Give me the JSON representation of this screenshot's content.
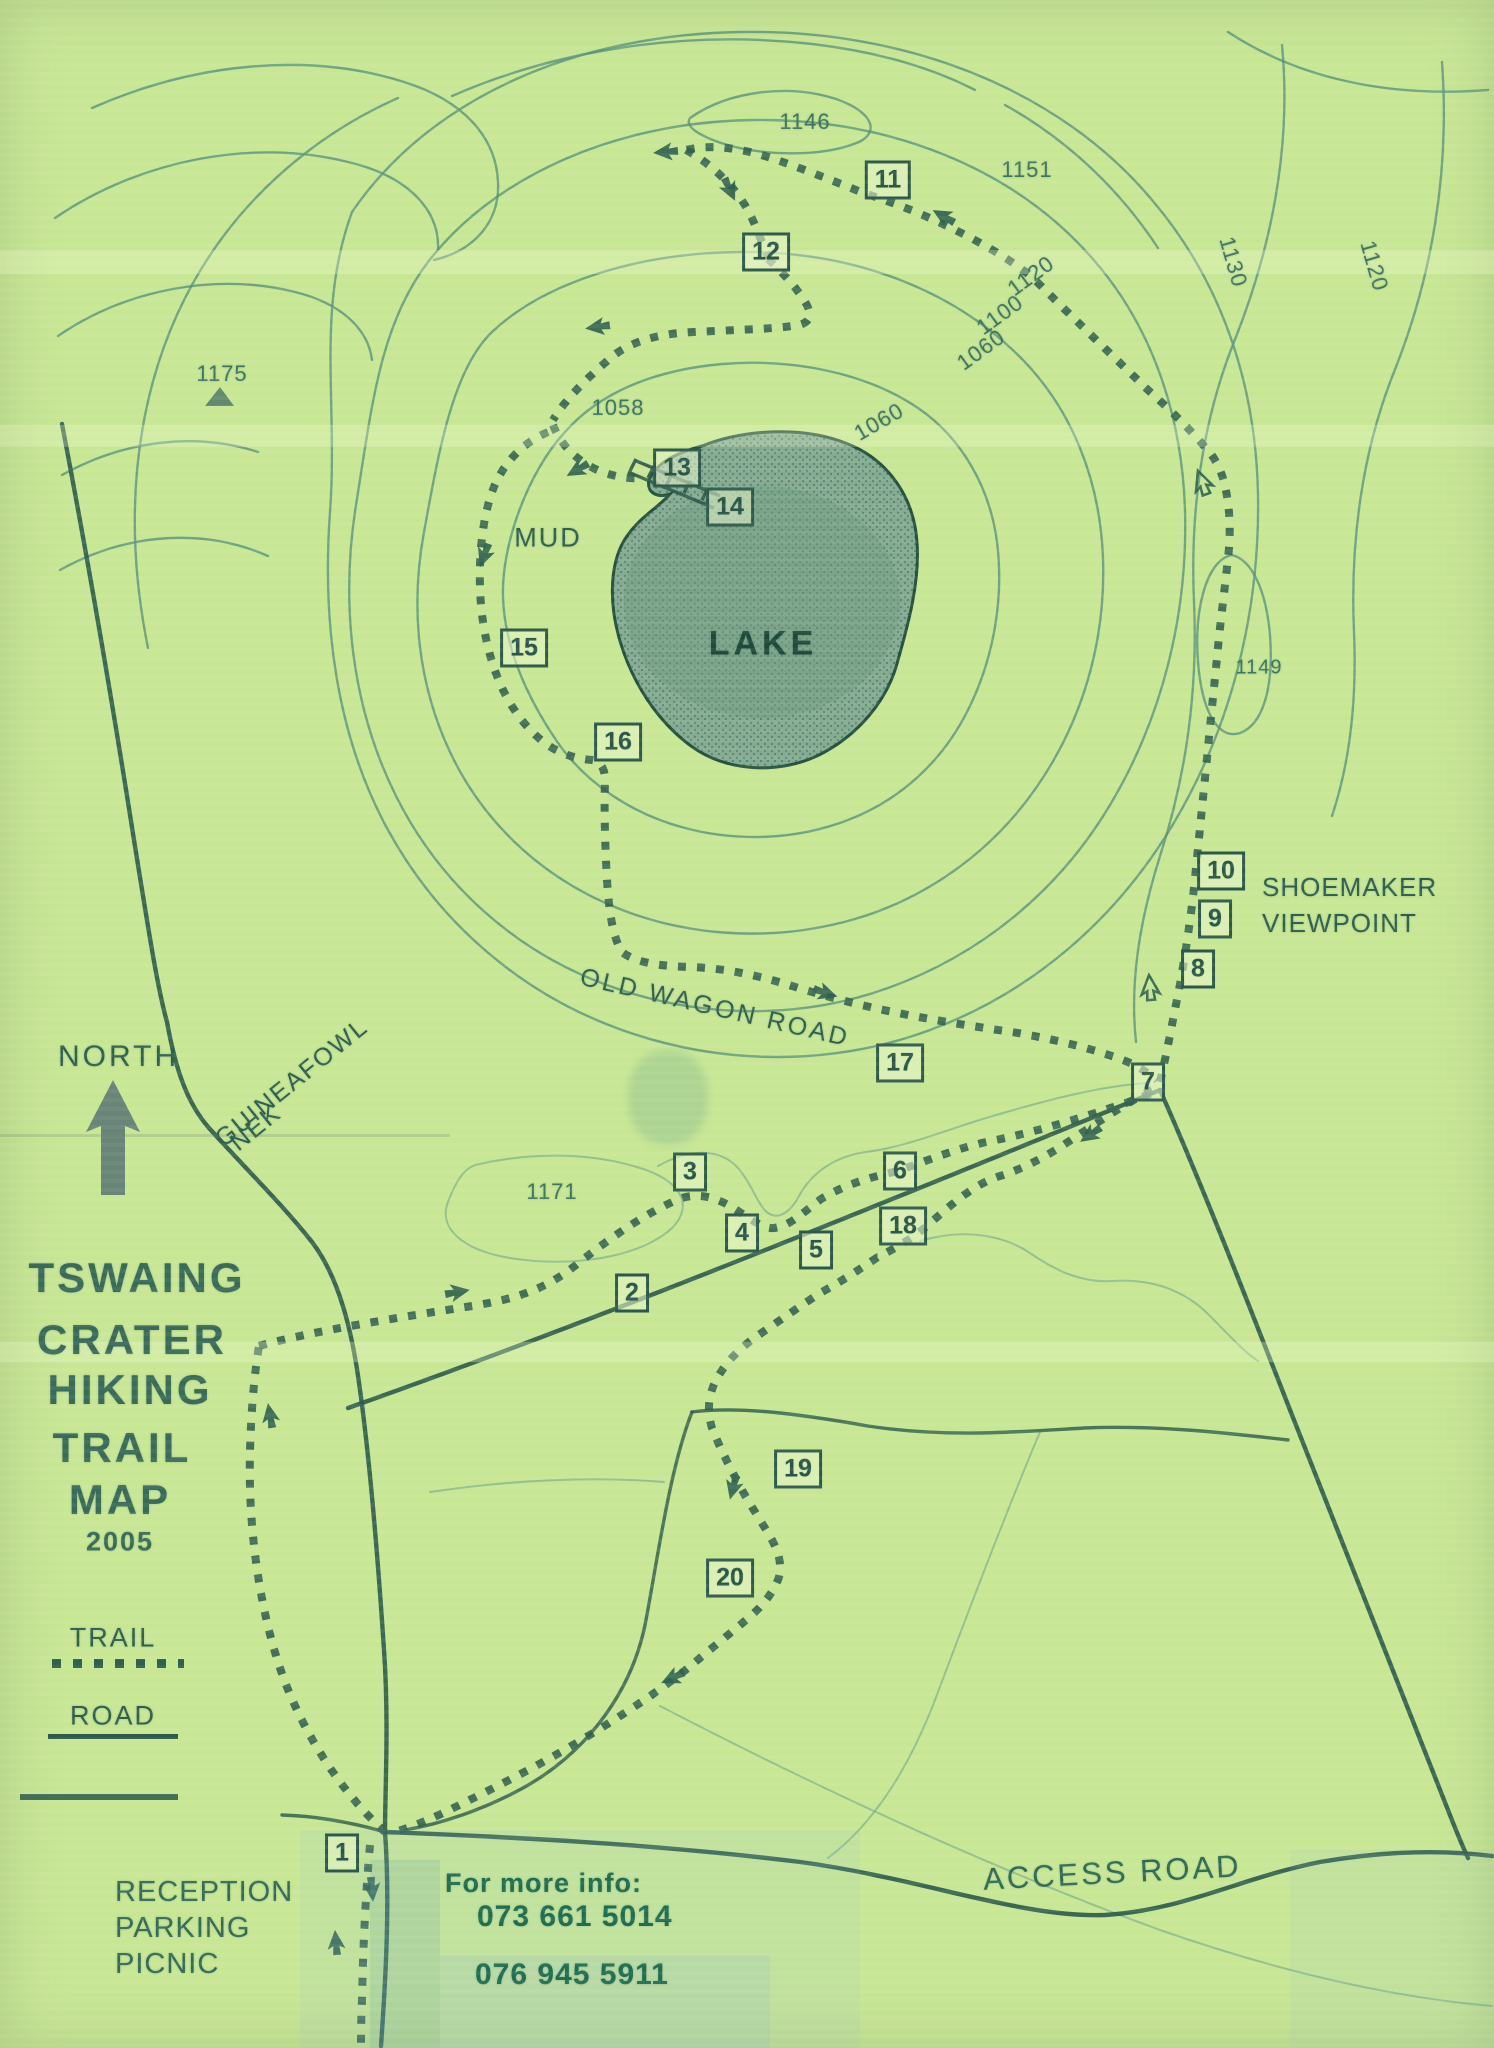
{
  "title": {
    "line1": "TSWAING",
    "line2": "CRATER",
    "line3": "HIKING",
    "line4": "TRAIL",
    "line5": "MAP",
    "year": "2005"
  },
  "legend": {
    "trail": "TRAIL",
    "road": "ROAD"
  },
  "compass": {
    "north": "NORTH"
  },
  "labels": {
    "lake": "LAKE",
    "mud": "MUD",
    "old_wagon_road": "OLD WAGON ROAD",
    "guineafowl": "GUINEAFOWL",
    "nek": "NEK",
    "shoemaker": "SHOEMAKER",
    "viewpoint": "VIEWPOINT",
    "access_road": "ACCESS ROAD",
    "reception": "RECEPTION",
    "parking": "PARKING",
    "picnic": "PICNIC"
  },
  "info": {
    "heading": "For more info:",
    "phone1": "073 661 5014",
    "phone2": "076 945 5911"
  },
  "elevations": {
    "n_1146": "1146",
    "ne_1151": "1151",
    "e_1130": "1130",
    "far_e_1120": "1120",
    "ne_1120": "1120",
    "ne_1100": "1100",
    "ne_1060": "1060",
    "inner_1060": "1060",
    "inner_1058": "1058",
    "e_1149": "1149",
    "w_1175": "1175",
    "sw_1171": "1171"
  },
  "waypoints": [
    "1",
    "2",
    "3",
    "4",
    "5",
    "6",
    "7",
    "8",
    "9",
    "10",
    "11",
    "12",
    "13",
    "14",
    "15",
    "16",
    "17",
    "18",
    "19",
    "20"
  ],
  "colors": {
    "paper": "#c8e795",
    "ink": "#2e5a4b",
    "contour": "#57917a",
    "trail": "#30604f",
    "lake_fill": "#86ab93",
    "marker_text": "#1f6e51",
    "watermark_blue": "#9cc4d4"
  }
}
